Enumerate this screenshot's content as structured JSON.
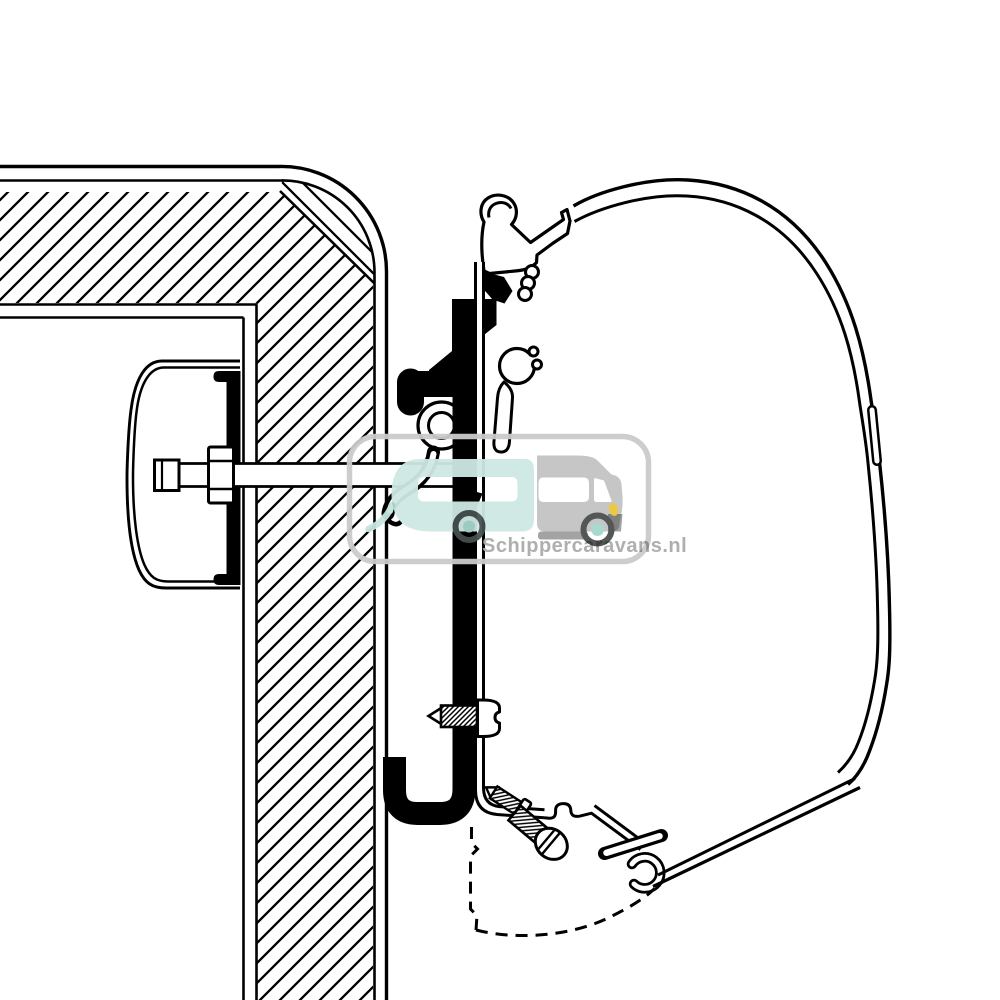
{
  "diagram": {
    "background_color": "#ffffff",
    "line_color": "#000000"
  },
  "watermark": {
    "text": "Schippercaravans.nl",
    "text_color": "#ababab",
    "border_color": "#cbcbcb",
    "caravan_color": "#cfe8e3",
    "hitch_color": "#c6e5df",
    "van_color": "#c3c3c3",
    "van_shade_color": "#9f9f9f",
    "wheel_ring_color": "#45504d",
    "van_wheel_ring_color": "#4a4f4d",
    "wheel_hub_color": "#a5d6cf",
    "headlight_color": "#e9c73c"
  }
}
